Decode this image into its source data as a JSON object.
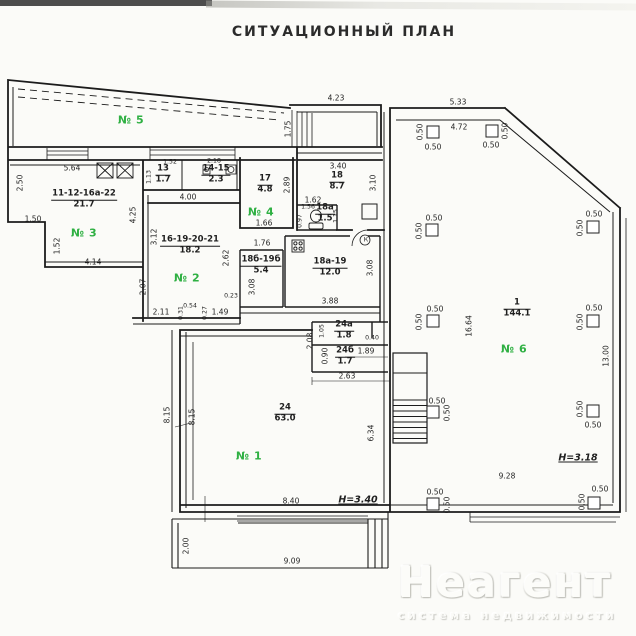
{
  "title": "СИТУАЦИОННЫЙ ПЛАН",
  "watermark": {
    "brand": "Неагент",
    "tagline": "система недвижимости"
  },
  "colors": {
    "green": "#2fb043",
    "ink": "#1c1c1c"
  },
  "green_labels": [
    {
      "text": "№ 5",
      "x": 131,
      "y": 120
    },
    {
      "text": "№ 3",
      "x": 84,
      "y": 233
    },
    {
      "text": "№ 4",
      "x": 261,
      "y": 212
    },
    {
      "text": "№ 2",
      "x": 187,
      "y": 278
    },
    {
      "text": "№ 1",
      "x": 249,
      "y": 456
    },
    {
      "text": "№ 6",
      "x": 514,
      "y": 349
    }
  ],
  "rooms": [
    {
      "number": "11-12-16а-22",
      "area": "21.7",
      "x": 84,
      "y": 200
    },
    {
      "number": "13",
      "area": "1.7",
      "x": 163,
      "y": 175
    },
    {
      "number": "14-15",
      "area": "2.3",
      "x": 216,
      "y": 175
    },
    {
      "number": "17",
      "area": "4.8",
      "x": 265,
      "y": 185
    },
    {
      "number": "18",
      "area": "8.7",
      "x": 337,
      "y": 182
    },
    {
      "number": "18а",
      "area": "1.5",
      "x": 325,
      "y": 214
    },
    {
      "number": "16-19-20-21",
      "area": "18.2",
      "x": 190,
      "y": 246
    },
    {
      "number": "18б-19б",
      "area": "5.4",
      "x": 261,
      "y": 266
    },
    {
      "number": "18а-19",
      "area": "12.0",
      "x": 330,
      "y": 268
    },
    {
      "number": "24а",
      "area": "1.8",
      "x": 344,
      "y": 331
    },
    {
      "number": "24б",
      "area": "1.7",
      "x": 345,
      "y": 357
    },
    {
      "number": "24",
      "area": "63.0",
      "x": 285,
      "y": 414
    },
    {
      "number": "1",
      "area": "144.1",
      "x": 517,
      "y": 309
    }
  ],
  "heights": [
    {
      "text": "H=3.40",
      "x": 358,
      "y": 500
    },
    {
      "text": "H=3.18",
      "x": 578,
      "y": 458
    }
  ],
  "dims": [
    {
      "t": "5.64",
      "x": 72,
      "y": 168
    },
    {
      "t": "2.50",
      "x": 20,
      "y": 183,
      "r": 1
    },
    {
      "t": "1.50",
      "x": 33,
      "y": 219
    },
    {
      "t": "1.52",
      "x": 57,
      "y": 246,
      "r": 1
    },
    {
      "t": "4.14",
      "x": 93,
      "y": 262
    },
    {
      "t": "4.25",
      "x": 133,
      "y": 215,
      "r": 1
    },
    {
      "t": "3.12",
      "x": 154,
      "y": 237,
      "r": 1
    },
    {
      "t": "2.07",
      "x": 143,
      "y": 287,
      "r": 1
    },
    {
      "t": "1.52",
      "x": 170,
      "y": 162,
      "s": 1
    },
    {
      "t": "1.13",
      "x": 149,
      "y": 177,
      "r": 1,
      "s": 1
    },
    {
      "t": "2.18",
      "x": 214,
      "y": 161,
      "s": 1
    },
    {
      "t": "4.00",
      "x": 188,
      "y": 197
    },
    {
      "t": "2.89",
      "x": 287,
      "y": 185,
      "r": 1
    },
    {
      "t": "1.66",
      "x": 264,
      "y": 223
    },
    {
      "t": "3.40",
      "x": 338,
      "y": 166
    },
    {
      "t": "3.10",
      "x": 373,
      "y": 183,
      "r": 1
    },
    {
      "t": "1.62",
      "x": 313,
      "y": 200
    },
    {
      "t": "1.56",
      "x": 308,
      "y": 207,
      "s": 1
    },
    {
      "t": "0.97",
      "x": 300,
      "y": 221,
      "r": 1,
      "s": 1
    },
    {
      "t": "1.15",
      "x": 336,
      "y": 216,
      "r": 1,
      "s": 1
    },
    {
      "t": "4.23",
      "x": 336,
      "y": 98
    },
    {
      "t": "1.75",
      "x": 288,
      "y": 129,
      "r": 1
    },
    {
      "t": "5.33",
      "x": 458,
      "y": 102
    },
    {
      "t": "4.72",
      "x": 459,
      "y": 127
    },
    {
      "t": "2.11",
      "x": 161,
      "y": 312
    },
    {
      "t": "0.54",
      "x": 190,
      "y": 306,
      "s": 1
    },
    {
      "t": "0.31",
      "x": 181,
      "y": 313,
      "r": 1,
      "s": 1
    },
    {
      "t": "0.27",
      "x": 205,
      "y": 313,
      "r": 1,
      "s": 1
    },
    {
      "t": "1.49",
      "x": 220,
      "y": 312
    },
    {
      "t": "0.23",
      "x": 231,
      "y": 296,
      "s": 1
    },
    {
      "t": "2.62",
      "x": 226,
      "y": 258,
      "r": 1
    },
    {
      "t": "3.08",
      "x": 252,
      "y": 287,
      "r": 1
    },
    {
      "t": "1.76",
      "x": 262,
      "y": 243
    },
    {
      "t": "3.88",
      "x": 330,
      "y": 301
    },
    {
      "t": "3.08",
      "x": 370,
      "y": 268,
      "r": 1
    },
    {
      "t": "2.08",
      "x": 310,
      "y": 341,
      "r": 1
    },
    {
      "t": "1.05",
      "x": 322,
      "y": 331,
      "r": 1,
      "s": 1
    },
    {
      "t": "0.90",
      "x": 325,
      "y": 356,
      "r": 1
    },
    {
      "t": "1.89",
      "x": 366,
      "y": 351
    },
    {
      "t": "0.40",
      "x": 372,
      "y": 338,
      "s": 1
    },
    {
      "t": "2.63",
      "x": 347,
      "y": 376
    },
    {
      "t": "8.15",
      "x": 167,
      "y": 415,
      "r": 1
    },
    {
      "t": "8.15",
      "x": 192,
      "y": 417,
      "r": 1
    },
    {
      "t": "6.34",
      "x": 371,
      "y": 433,
      "r": 1
    },
    {
      "t": "8.40",
      "x": 291,
      "y": 501
    },
    {
      "t": "2.00",
      "x": 186,
      "y": 546,
      "r": 1
    },
    {
      "t": "9.09",
      "x": 292,
      "y": 561
    },
    {
      "t": "16.64",
      "x": 469,
      "y": 326,
      "r": 1
    },
    {
      "t": "13.00",
      "x": 606,
      "y": 356,
      "r": 1
    },
    {
      "t": "9.28",
      "x": 507,
      "y": 476
    },
    {
      "t": "К",
      "x": 366,
      "y": 240,
      "s": 1
    },
    {
      "t": "0.50",
      "x": 433,
      "y": 147
    },
    {
      "t": "0.50",
      "x": 420,
      "y": 132,
      "r": 1
    },
    {
      "t": "0.50",
      "x": 491,
      "y": 145
    },
    {
      "t": "0.50",
      "x": 505,
      "y": 131,
      "r": 1
    },
    {
      "t": "0.50",
      "x": 434,
      "y": 218
    },
    {
      "t": "0.50",
      "x": 419,
      "y": 231,
      "r": 1
    },
    {
      "t": "0.50",
      "x": 594,
      "y": 214
    },
    {
      "t": "0.50",
      "x": 580,
      "y": 228,
      "r": 1
    },
    {
      "t": "0.50",
      "x": 435,
      "y": 309
    },
    {
      "t": "0.50",
      "x": 419,
      "y": 322,
      "r": 1
    },
    {
      "t": "0.50",
      "x": 594,
      "y": 308
    },
    {
      "t": "0.50",
      "x": 580,
      "y": 322,
      "r": 1
    },
    {
      "t": "0.50",
      "x": 437,
      "y": 401
    },
    {
      "t": "0.50",
      "x": 447,
      "y": 413,
      "r": 1
    },
    {
      "t": "0.50",
      "x": 593,
      "y": 425
    },
    {
      "t": "0.50",
      "x": 580,
      "y": 409,
      "r": 1
    },
    {
      "t": "0.50",
      "x": 435,
      "y": 492
    },
    {
      "t": "0.50",
      "x": 447,
      "y": 505,
      "r": 1
    },
    {
      "t": "0.50",
      "x": 600,
      "y": 489
    },
    {
      "t": "0.50",
      "x": 582,
      "y": 502,
      "r": 1
    }
  ],
  "columns": [
    {
      "x": 433,
      "y": 132
    },
    {
      "x": 492,
      "y": 131
    },
    {
      "x": 432,
      "y": 230
    },
    {
      "x": 593,
      "y": 227
    },
    {
      "x": 433,
      "y": 321
    },
    {
      "x": 593,
      "y": 321
    },
    {
      "x": 433,
      "y": 412
    },
    {
      "x": 593,
      "y": 411
    },
    {
      "x": 433,
      "y": 504
    },
    {
      "x": 594,
      "y": 503
    }
  ]
}
